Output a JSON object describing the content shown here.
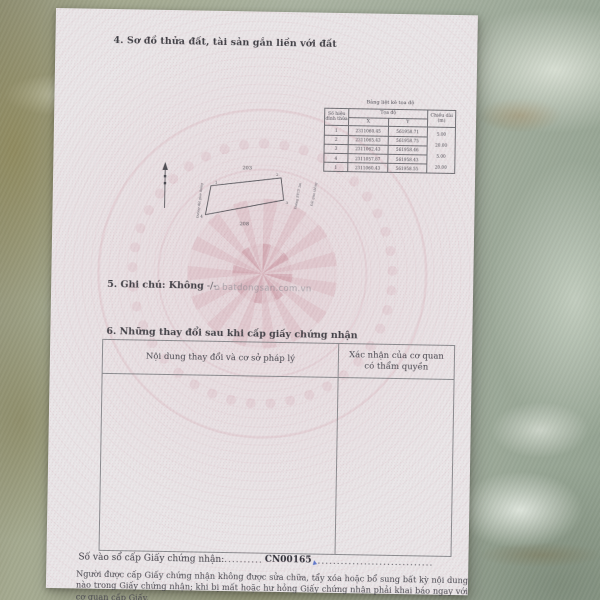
{
  "colors": {
    "paper": "#eae6e8",
    "pattern_pink": "#c9808f",
    "ink": "#3f3e44",
    "table_border": "#8a8a8e",
    "blue_pen_mark": "#4a66c8"
  },
  "icons": {
    "watermark_house": "⌂",
    "north_arrow": "↑"
  },
  "certificate": {
    "section4_heading": "4. Sơ đồ thửa đất, tài sản gắn liền với đất",
    "coordinate_table": {
      "title": "Bảng liệt kê tọa độ",
      "headers": {
        "vertex": "Số hiệu đỉnh thửa",
        "coords": "Tọa độ",
        "x": "X",
        "y": "Y",
        "length": "Chiều dài (m)"
      },
      "rows": [
        {
          "v": "1",
          "x": "2311060.45",
          "y": "561958.71"
        },
        {
          "v": "2",
          "x": "2311065.43",
          "y": "561958.75"
        },
        {
          "v": "3",
          "x": "2311062.43",
          "y": "561958.46"
        },
        {
          "v": "4",
          "x": "2311057.87",
          "y": "561958.43"
        },
        {
          "v": "1",
          "x": "2311060.43",
          "y": "561958.55"
        }
      ],
      "edge_lengths": [
        "5.00",
        "20.00",
        "5.00",
        "20.00"
      ]
    },
    "diagram": {
      "adjacent_parcel_top": "203",
      "adjacent_parcel_bottom": "208",
      "vertex_1": "1",
      "vertex_2": "2",
      "vertex_3": "3",
      "vertex_4": "4",
      "left_label": "Đường đất giao thông",
      "right_label_1": "Đường BTCT 3m",
      "right_label_2": "Đất giao thông"
    },
    "section5_heading": "5. Ghi chú:",
    "section5_value": "Không",
    "section5_suffix": "-/-",
    "watermark": "batdongsan.com.vn",
    "section6_heading": "6. Những thay đổi sau khi cấp giấy chứng nhận",
    "changes_table": {
      "col_content": "Nội dung thay đổi và cơ sở pháp lý",
      "col_confirm": "Xác nhận của cơ quan có thẩm quyền"
    },
    "registry": {
      "label": "Số vào sổ cấp Giấy chứng nhận:",
      "dots_left": "..........",
      "value": "CN00165",
      "dots_right": ".............................."
    },
    "notice": "Người được cấp Giấy chứng nhận không được sửa chữa, tẩy xóa hoặc bổ sung bất kỳ nội dung nào trong Giấy chứng nhận; khi bị mất hoặc hư hỏng Giấy chứng nhận phải khai báo ngay với cơ quan cấp Giấy."
  }
}
